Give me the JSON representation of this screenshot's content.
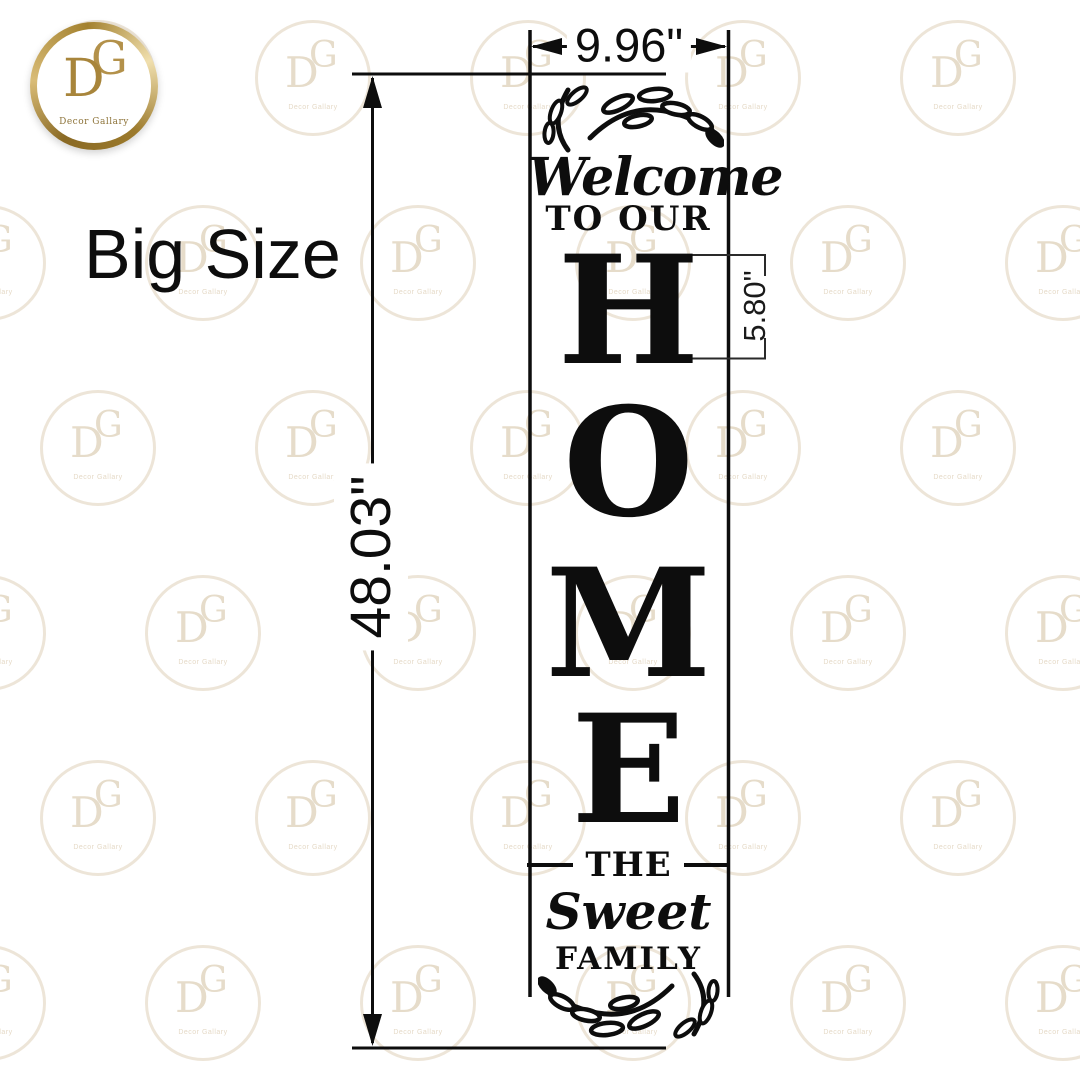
{
  "brand": {
    "monogram_d": "D",
    "monogram_g": "G",
    "caption": "Decor Gallary"
  },
  "annotations": {
    "size_label": "Big Size",
    "width": "9.96\"",
    "height": "48.03\"",
    "letter_height": "5.80\""
  },
  "sign": {
    "greeting": "Welcome",
    "subline": "TO OUR",
    "word_letters": [
      "H",
      "O",
      "M",
      "E"
    ],
    "divider_word": "THE",
    "family_name": "Sweet",
    "family_word": "FAMILY"
  },
  "watermark": {
    "monogram_d": "D",
    "monogram_g": "G",
    "caption": "Decor Gallary"
  },
  "colors": {
    "ink": "#0d0d0d",
    "gold": "#a8853b",
    "watermark": "#ded0b8"
  }
}
